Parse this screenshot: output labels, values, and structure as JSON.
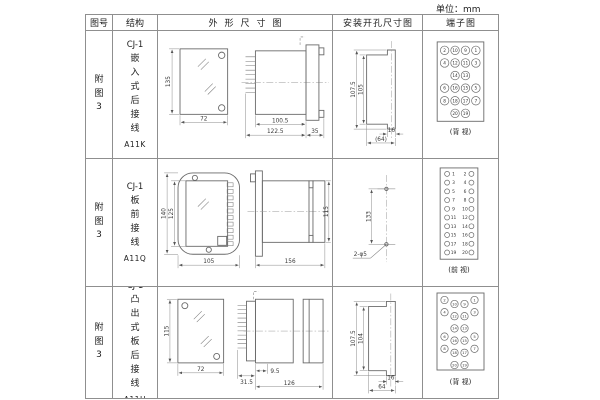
{
  "unit_label": "单位：mm",
  "table": {
    "headers": {
      "figure": "图号",
      "structure": "结构",
      "outline": "外形尺寸图",
      "install": "安装开孔尺寸图",
      "terminal": "端子图"
    },
    "rows": [
      {
        "figure_no": "附图3",
        "structure": {
          "model": "CJ-1",
          "mounting": "嵌入式后接线",
          "code": "A11K"
        },
        "outline": {
          "front_h": "135",
          "front_w": "72",
          "side_d1": "100.5",
          "side_d2": "122.5",
          "side_d3": "35"
        },
        "install": {
          "v_outer": "107.5",
          "v_inner": "105",
          "h_slot": "16",
          "h_total": "(64)"
        },
        "terminal": {
          "layout": "grid",
          "rows": [
            [
              "2",
              "10",
              "9",
              "1"
            ],
            [
              "4",
              "12",
              "11",
              "3"
            ],
            [
              "14",
              "13"
            ],
            [
              "6",
              "16",
              "15",
              "5"
            ],
            [
              "8",
              "18",
              "17",
              "7"
            ],
            [
              "20",
              "19"
            ]
          ],
          "caption": "(背 视)"
        }
      },
      {
        "figure_no": "附图3",
        "structure": {
          "model": "CJ-1",
          "mounting": "板前接线",
          "code": "A11Q"
        },
        "outline": {
          "front_h_outer": "140",
          "front_h_inner": "125",
          "front_w": "105",
          "side_len": "156",
          "side_h": "115"
        },
        "install": {
          "hole_span": "133",
          "hole_callout": "2-φ5"
        },
        "terminal": {
          "layout": "dual",
          "left": [
            "1",
            "3",
            "5",
            "7",
            "9",
            "11",
            "13",
            "15",
            "17",
            "19"
          ],
          "right": [
            "2",
            "4",
            "6",
            "8",
            "10",
            "12",
            "14",
            "16",
            "18",
            "20"
          ],
          "caption": "(前 视)"
        }
      },
      {
        "figure_no": "附图3",
        "structure": {
          "model": "CJ-1",
          "mounting": "凸出式板后接线",
          "code": "A11H"
        },
        "outline": {
          "front_h": "115",
          "front_w": "72",
          "side_d1": "31.5",
          "side_d2": "9.5",
          "side_d3": "126"
        },
        "install": {
          "v_outer": "107.5",
          "v_inner": "104",
          "h_slot": "16",
          "h_total": "64"
        },
        "terminal": {
          "layout": "staggered",
          "rows": [
            [
              "2",
              "10",
              "9",
              "1"
            ],
            [
              "4",
              "12",
              "11",
              "3"
            ],
            [
              "14",
              "13"
            ],
            [
              "6",
              "16",
              "15",
              "5"
            ],
            [
              "8",
              "18",
              "17",
              "7"
            ],
            [
              "20",
              "19"
            ]
          ],
          "caption": "(背 视)"
        }
      }
    ]
  },
  "colors": {
    "line": "#696969",
    "table_border": "#8f8f8f",
    "text": "#222222"
  }
}
